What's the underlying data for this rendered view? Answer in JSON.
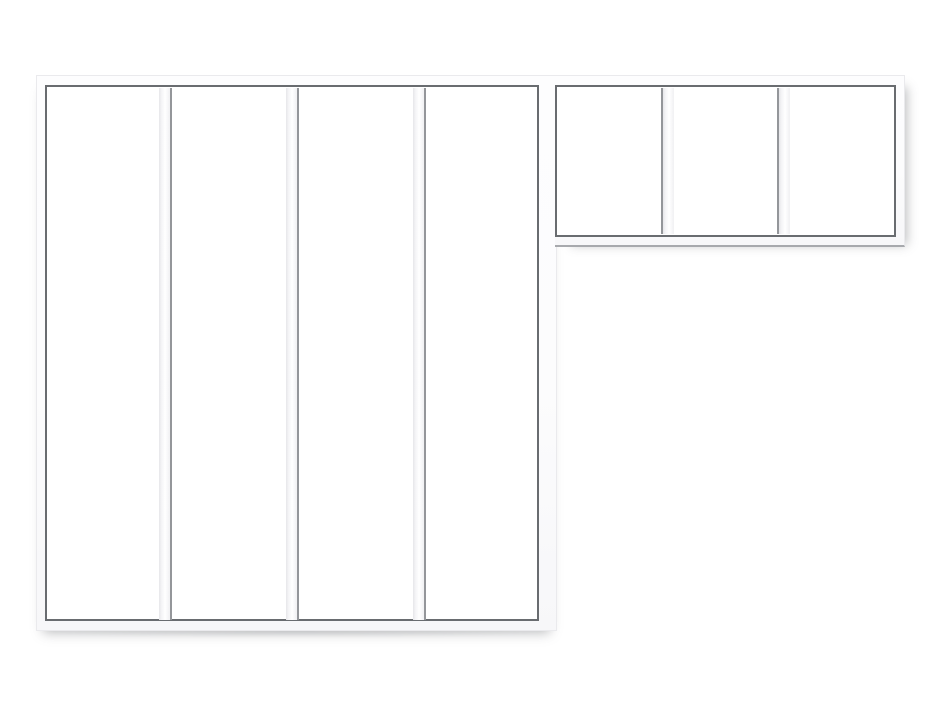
{
  "image": {
    "type": "product-photo",
    "subject": "White aluminium atelier-style glass partition (verriere), L-shaped assembly on plain white background",
    "tall_section_label": "tall wall section, 4 vertical glass panels",
    "transom_section_label": "upper transom section, 3 glass panels",
    "background": "#ffffff"
  },
  "sections": {
    "tall": {
      "panel_count": 4,
      "mullion_count": 3
    },
    "transom": {
      "panel_count": 3,
      "mullion_count": 2
    }
  },
  "palette": {
    "background": "#ffffff",
    "frame_white": "#fcfcfd",
    "frame_edge": "#eaeaed",
    "glazing_line": "#696c70",
    "mullion_fill_start": "#e6e6e9",
    "mullion_edge": "#94969a",
    "underline_gray": "#a7a9ad",
    "shadow": "rgba(110,112,118,0.45)"
  }
}
